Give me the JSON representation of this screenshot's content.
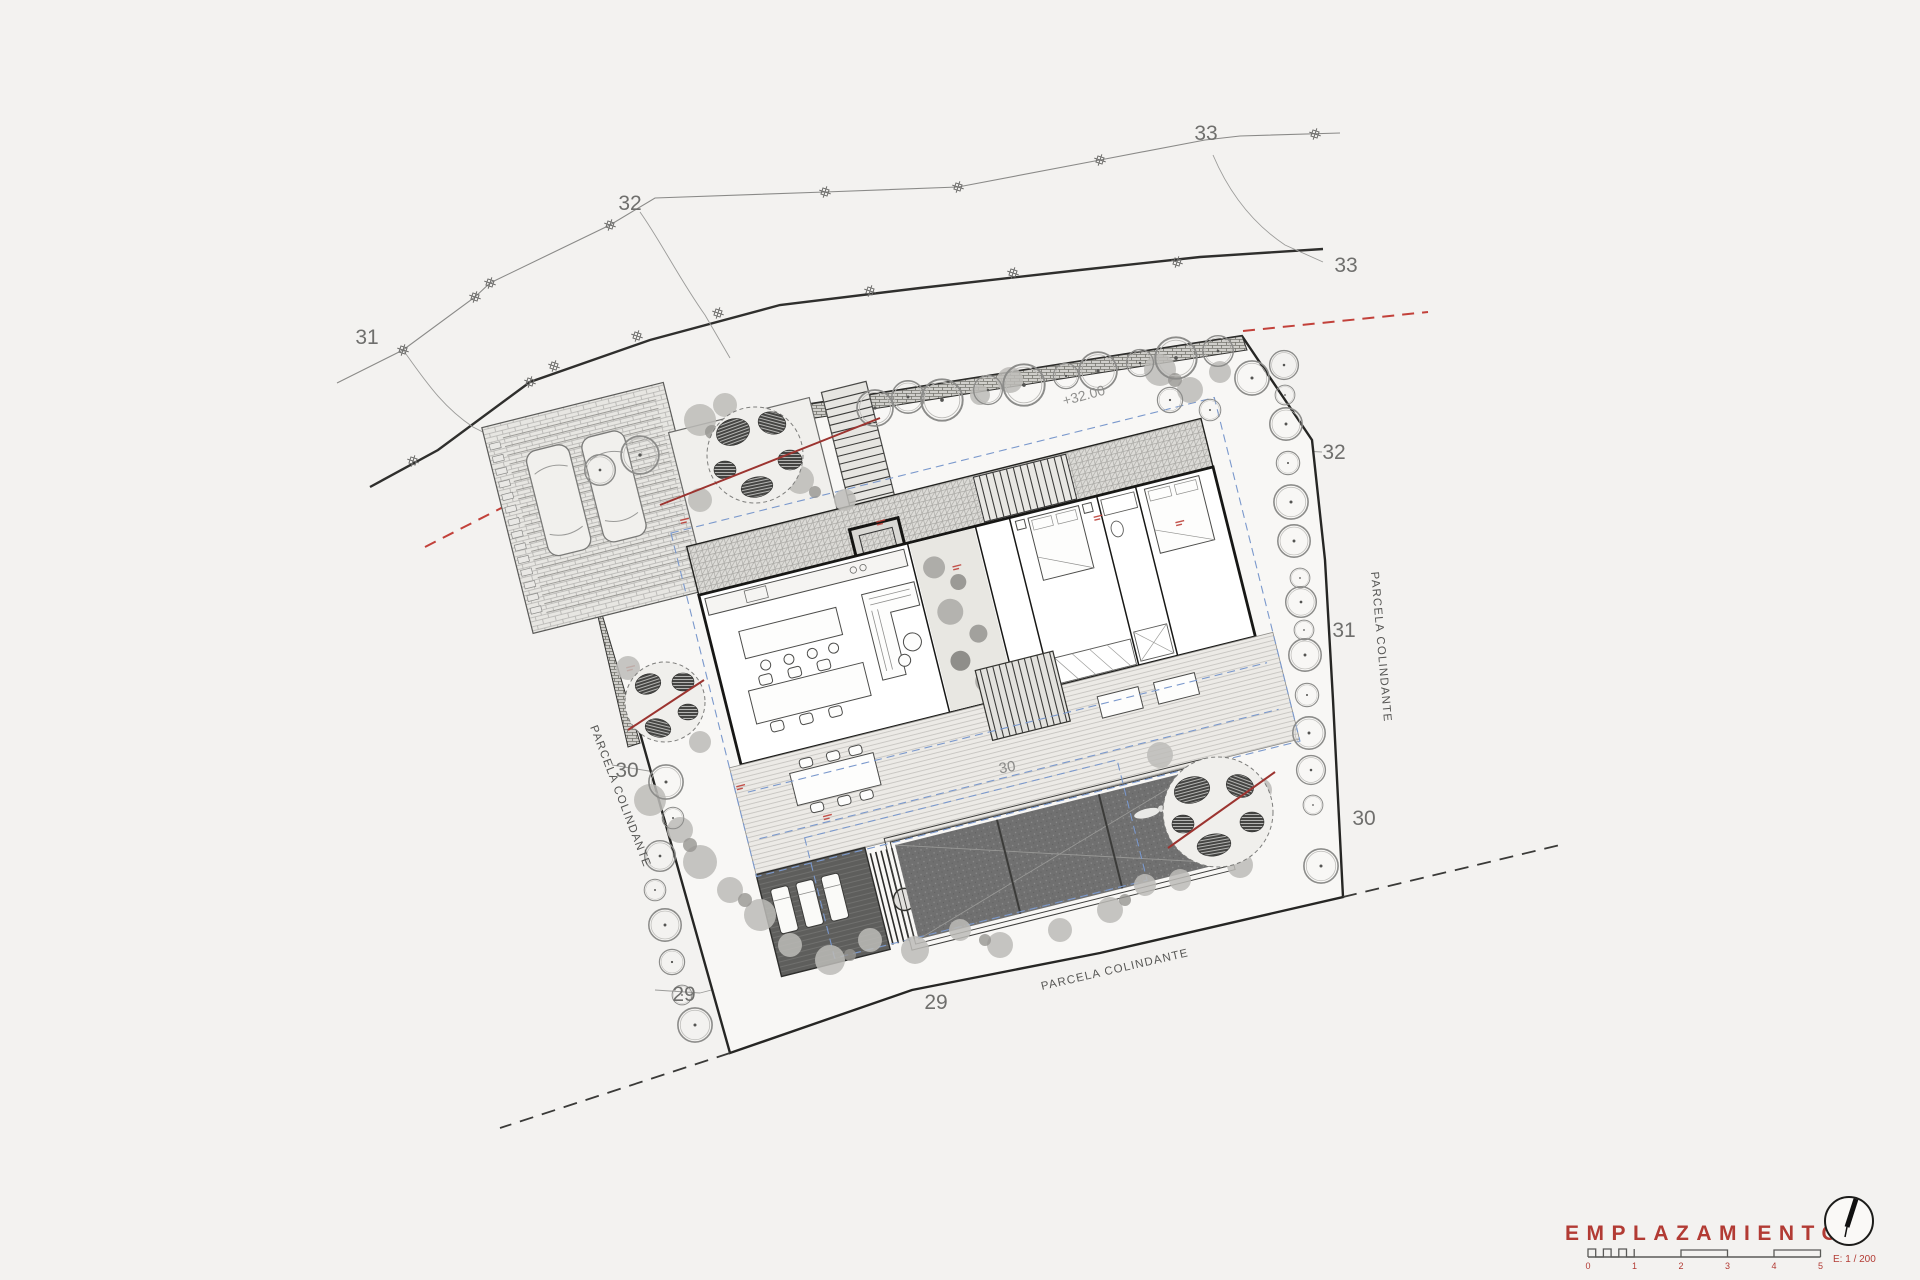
{
  "plan": {
    "contours": {
      "c31_left": "31",
      "c32_top": "32",
      "c33_top": "33",
      "c33_right": "33",
      "c32_right": "32",
      "c31_right": "31",
      "c30_right": "30",
      "c30_left": "30",
      "c29_left": "29",
      "c29_bottom": "29",
      "c30_deck": "30"
    },
    "parcel_labels": {
      "left": "PARCELA COLINDANTE",
      "right": "PARCELA COLINDANTE",
      "bottom": "PARCELA COLINDANTE"
    },
    "spot_elevation": "+32.00"
  },
  "title_block": {
    "title": "EMPLAZAMIENTO",
    "scale_label": "E: 1 / 200",
    "scale_ticks": [
      "0",
      "1",
      "2",
      "3",
      "4",
      "5"
    ]
  },
  "colors": {
    "accent_red": "#b23b34",
    "line_dark": "#2e2e2c",
    "line_gray": "#8a8a88",
    "roof_outline_blue": "#7a98cc"
  }
}
